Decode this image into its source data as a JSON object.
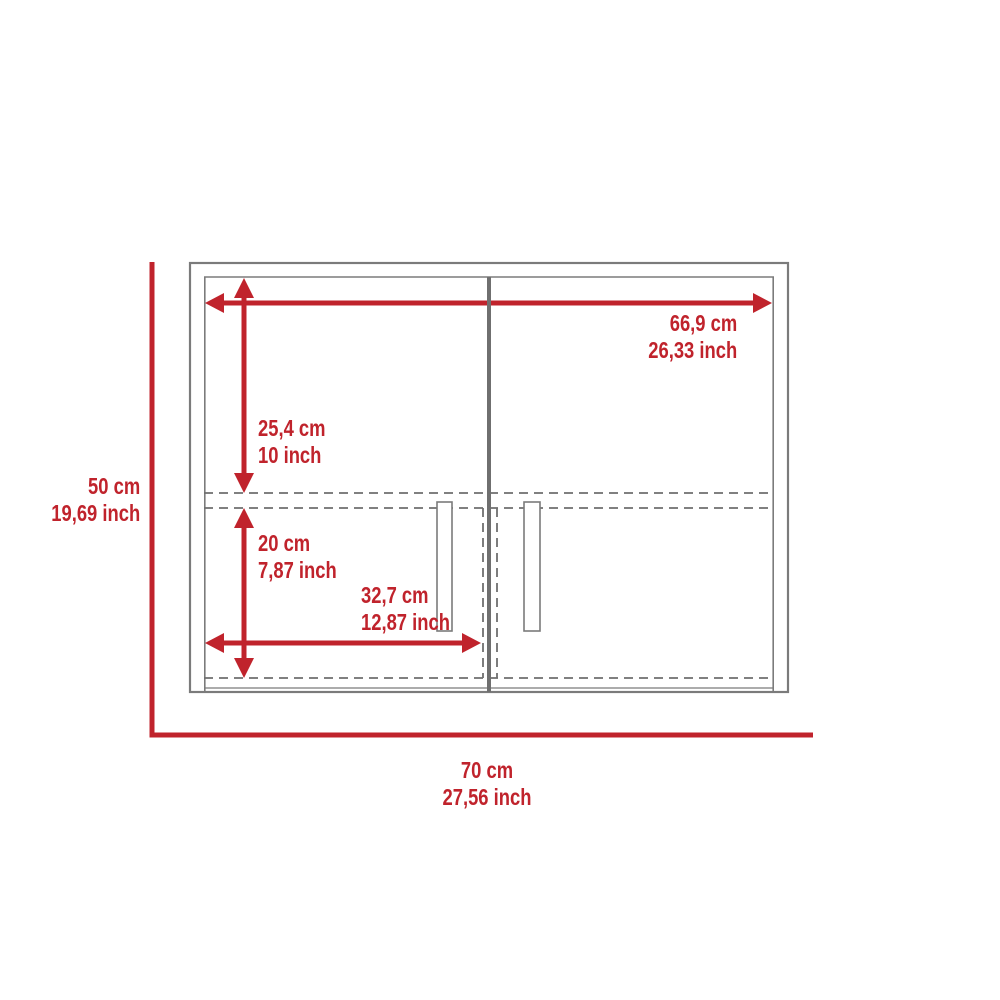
{
  "title": "Wall cabinet dimension diagram",
  "colors": {
    "accent_red": "#c0232c",
    "carcass_line": "#7b7b7b",
    "divider_line": "#6f6f6f",
    "dashed_line": "#6f6f6f",
    "background": "#ffffff"
  },
  "dimensions": {
    "overall_height": {
      "cm": "50 cm",
      "inch": "19,69 inch"
    },
    "overall_width": {
      "cm": "70 cm",
      "inch": "27,56 inch"
    },
    "interior_width": {
      "cm": "66,9 cm",
      "inch": "26,33 inch"
    },
    "upper_section_height": {
      "cm": "25,4 cm",
      "inch": "10 inch"
    },
    "lower_section_height": {
      "cm": "20 cm",
      "inch": "7,87 inch"
    },
    "door_width": {
      "cm": "32,7 cm",
      "inch": "12,87 inch"
    }
  }
}
